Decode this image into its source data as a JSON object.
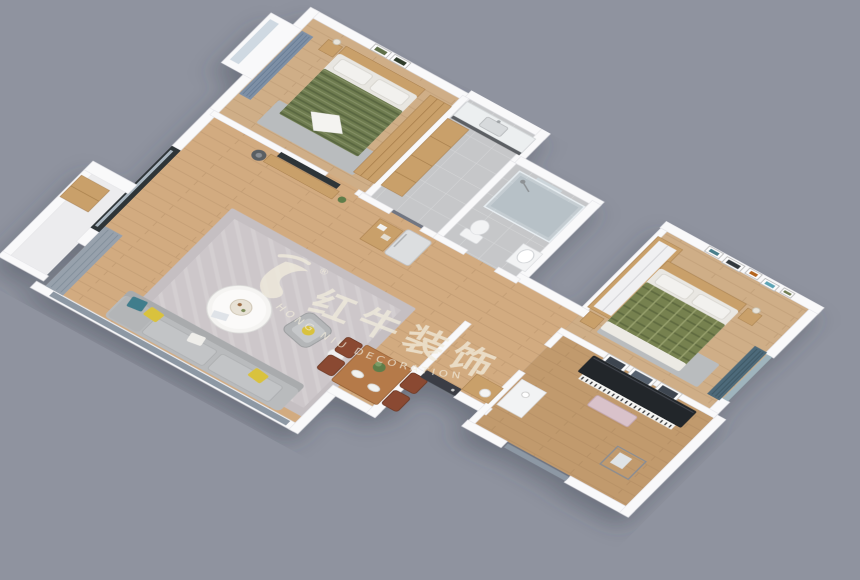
{
  "image": {
    "type": "3d-isometric-apartment-floor-plan-render",
    "background_color": "#8f939f",
    "description": "Bird's-eye 3D cutaway rendering of a two-bedroom apartment with open living-dining area"
  },
  "watermark": {
    "logo": "red-bull-brush-logo",
    "registered_mark": "®",
    "brand_cn": "红牛装饰",
    "brand_en": "HONG NIU DECORATION",
    "text_color": "#f2ecdc"
  },
  "rooms": [
    {
      "id": "bedroom-secondary",
      "label": "secondary bedroom",
      "furniture": [
        "green-striped-double-bed",
        "wood-headboard",
        "nightstand-lamp",
        "two-wall-frames",
        "wood-wardrobe",
        "blue-curtain",
        "bay-window",
        "gray-rug"
      ]
    },
    {
      "id": "kitchen",
      "label": "kitchen",
      "furniture": [
        "white-sink-counter",
        "faucet",
        "tall-wood-cabinet"
      ]
    },
    {
      "id": "bathroom",
      "label": "bathroom",
      "furniture": [
        "glass-shower-enclosure",
        "shower-head",
        "toilet",
        "washbasin",
        "wall-mirror"
      ]
    },
    {
      "id": "living-room",
      "label": "living room",
      "furniture": [
        "gray-sofa",
        "yellow-pillows",
        "teal-pattern-pillow",
        "round-coffee-table",
        "decor-tray",
        "area-rug",
        "tv-panel",
        "wood-tv-stand",
        "floor-lamp",
        "armchair",
        "side-stool",
        "black-frame-window",
        "gray-curtain",
        "balcony-glass-wall"
      ]
    },
    {
      "id": "dining-area",
      "label": "dining area",
      "furniture": [
        "wood-dining-table",
        "four-chairs",
        "potted-plant",
        "plates"
      ]
    },
    {
      "id": "hallway",
      "label": "entry hallway",
      "furniture": [
        "refrigerator",
        "wood-storage-shelf",
        "entry-door",
        "shoe-cabinet",
        "white-vase"
      ]
    },
    {
      "id": "bedroom-master",
      "label": "master bedroom",
      "furniture": [
        "green-plaid-double-bed",
        "wood-headboard",
        "two-nightstands",
        "photo-wall-frames",
        "wardrobe",
        "teal-curtain-window",
        "gray-rug"
      ]
    },
    {
      "id": "piano-room",
      "label": "piano room / study",
      "furniture": [
        "black-upright-piano",
        "pink-piano-bench",
        "three-wall-frames",
        "white-desk",
        "clothes-rack",
        "window"
      ]
    },
    {
      "id": "balcony",
      "label": "balcony",
      "furniture": [
        "wood-storage-cabinet"
      ]
    }
  ],
  "palette": {
    "background": "#8f939f",
    "wall": "#f9f9fa",
    "wood_floor": "#d2ab80",
    "wood_floor_dark": "#c19a6d",
    "tile_floor": "#c6c7c9",
    "wood_furniture": "#c9a06a",
    "rug": "#c5bfc2",
    "sofa_gray": "#b9bbbd",
    "bed_green_stripe": "#6e7b50",
    "bed_green_plaid": "#76814f",
    "dining_wood": "#b57a48",
    "curtain_blue": "#7e90a6",
    "curtain_teal": "#4e6b7a",
    "curtain_gray": "#97a1ac",
    "piano_black": "#22252a",
    "yellow_accent": "#d9c23c",
    "window_frame_dark": "#2e3438",
    "watermark_cream": "#f2ecdc"
  }
}
